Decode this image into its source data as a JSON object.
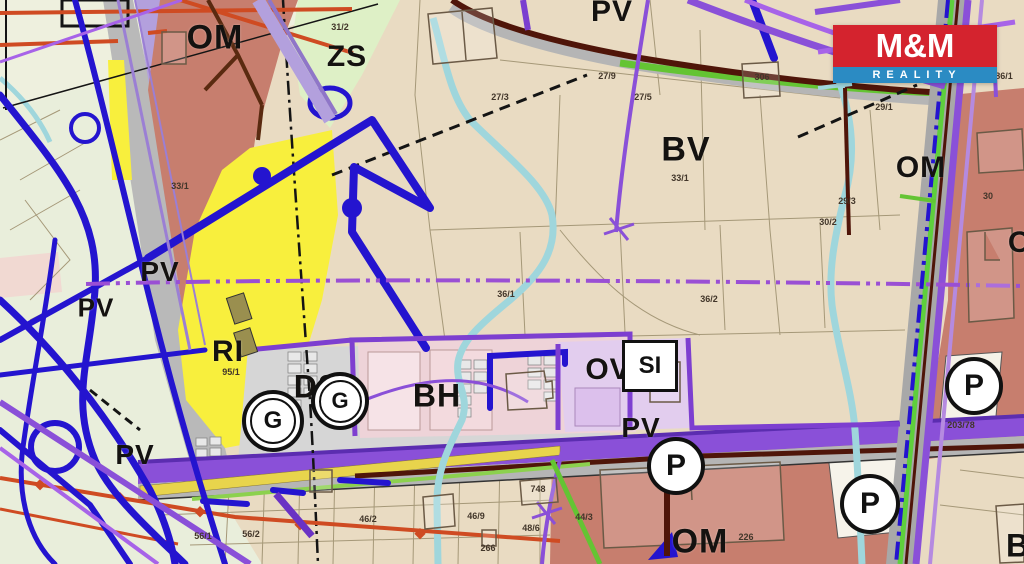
{
  "logo": {
    "title": "M&M",
    "subtitle": "REALITY",
    "red": "#d4232e",
    "blue": "#2b8bc3"
  },
  "zones": {
    "om_top_left": "OM",
    "zs": "ZS",
    "pv_top": "PV",
    "bv": "BV",
    "om_right": "OM",
    "pv_left_upper": "PV",
    "pv_left_lower": "PV",
    "ri": "RI",
    "ds": "DS",
    "bh": "BH",
    "ov": "OV",
    "si": "SI",
    "pv_bottom_left": "PV",
    "pv_center": "PV",
    "om_bottom": "OM",
    "o_partial": "O",
    "b_partial": "B"
  },
  "symbols": {
    "parking": "P",
    "garage": "G"
  },
  "parcels": [
    "31/2",
    "27/3",
    "27/5",
    "27/9",
    "306",
    "29/1",
    "33/1",
    "33/1",
    "30/2",
    "29/3",
    "36/1",
    "36/2",
    "95/1",
    "86/1",
    "30",
    "203/78",
    "56/1",
    "56/2",
    "46/2",
    "46/9",
    "48/6",
    "266",
    "748",
    "44/3",
    "226"
  ],
  "colors": {
    "base_parcel": "#e9dbc2",
    "green_area": "#e9eedb",
    "zs_green": "#def0c6",
    "om_salmon": "#c77e6e",
    "ri_yellow": "#f8ef3d",
    "ds_gray": "#d6d6d6",
    "bh_pink": "#eed3d8",
    "ov_lavender": "#e2cdee",
    "road_purple": "#8a50d8",
    "utility_navy": "#2414cf",
    "stream_cyan": "#9fd6dc",
    "road_maroon": "#4f1509",
    "line_green": "#64c433",
    "line_orange": "#cf4b22"
  }
}
